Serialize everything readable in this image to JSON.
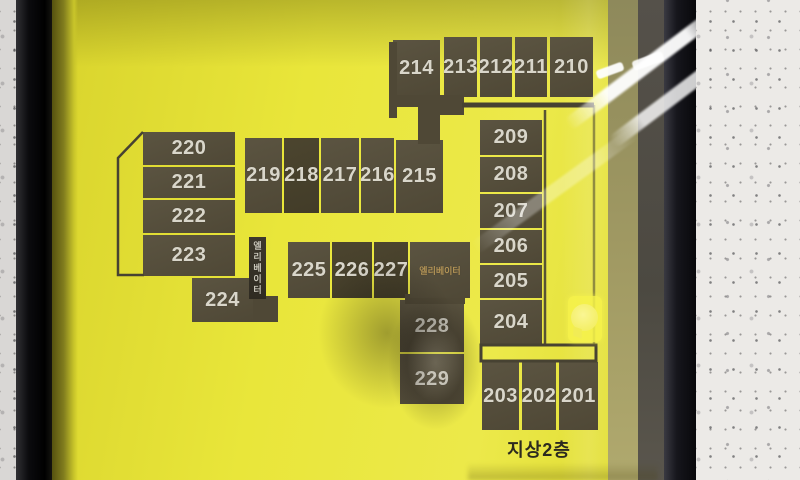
{
  "sign": {
    "type": "building-floor-directory",
    "colors": {
      "sign_yellow": "#e6e233",
      "block_brown": "#554e3b",
      "block_dark": "#2c2821",
      "outline": "#474232",
      "room_number_text": "#d9d6ca",
      "floor_label_text": "#2c2a1f",
      "elevator_text": "#c9c6ba",
      "elevator_room_text": "#b29356",
      "frame_black": "#141418",
      "wall_white": "#eceae7"
    }
  },
  "map": {
    "floor_label": "지상2층",
    "rooms": [
      {
        "number": "214",
        "x": 393,
        "y": 40,
        "w": 47,
        "h": 57
      },
      {
        "number": "213",
        "x": 444,
        "y": 37,
        "w": 33,
        "h": 60
      },
      {
        "number": "212",
        "x": 480,
        "y": 37,
        "w": 32,
        "h": 60
      },
      {
        "number": "211",
        "x": 515,
        "y": 37,
        "w": 32,
        "h": 60
      },
      {
        "number": "210",
        "x": 550,
        "y": 37,
        "w": 43,
        "h": 60
      },
      {
        "number": "220",
        "x": 143,
        "y": 132,
        "w": 92,
        "h": 33
      },
      {
        "number": "221",
        "x": 143,
        "y": 167,
        "w": 92,
        "h": 31
      },
      {
        "number": "222",
        "x": 143,
        "y": 200,
        "w": 92,
        "h": 33
      },
      {
        "number": "223",
        "x": 143,
        "y": 235,
        "w": 92,
        "h": 41
      },
      {
        "number": "224",
        "x": 192,
        "y": 278,
        "w": 61,
        "h": 44
      },
      {
        "number": "219",
        "x": 245,
        "y": 138,
        "w": 37,
        "h": 75
      },
      {
        "number": "218",
        "x": 284,
        "y": 138,
        "w": 35,
        "h": 75,
        "tone": "dim"
      },
      {
        "number": "217",
        "x": 321,
        "y": 138,
        "w": 38,
        "h": 75
      },
      {
        "number": "216",
        "x": 361,
        "y": 138,
        "w": 33,
        "h": 75
      },
      {
        "number": "215",
        "x": 396,
        "y": 140,
        "w": 47,
        "h": 73
      },
      {
        "number": "225",
        "x": 288,
        "y": 242,
        "w": 42,
        "h": 56
      },
      {
        "number": "226",
        "x": 332,
        "y": 242,
        "w": 40,
        "h": 56,
        "tone": "dim"
      },
      {
        "number": "227",
        "x": 374,
        "y": 242,
        "w": 34,
        "h": 56,
        "tone": "dim"
      },
      {
        "number": "228",
        "x": 400,
        "y": 300,
        "w": 64,
        "h": 52
      },
      {
        "number": "229",
        "x": 400,
        "y": 354,
        "w": 64,
        "h": 50
      },
      {
        "number": "209",
        "x": 480,
        "y": 120,
        "w": 62,
        "h": 35
      },
      {
        "number": "208",
        "x": 480,
        "y": 157,
        "w": 62,
        "h": 35
      },
      {
        "number": "207",
        "x": 480,
        "y": 194,
        "w": 62,
        "h": 34
      },
      {
        "number": "206",
        "x": 480,
        "y": 230,
        "w": 62,
        "h": 33
      },
      {
        "number": "205",
        "x": 480,
        "y": 265,
        "w": 62,
        "h": 33
      },
      {
        "number": "204",
        "x": 480,
        "y": 300,
        "w": 62,
        "h": 45
      },
      {
        "number": "203",
        "x": 482,
        "y": 362,
        "w": 37,
        "h": 68
      },
      {
        "number": "202",
        "x": 522,
        "y": 362,
        "w": 34,
        "h": 68
      },
      {
        "number": "201",
        "x": 559,
        "y": 362,
        "w": 39,
        "h": 68
      }
    ],
    "connectors": [
      {
        "x": 389,
        "y": 42,
        "w": 8,
        "h": 76
      },
      {
        "x": 389,
        "y": 95,
        "w": 30,
        "h": 12
      },
      {
        "x": 418,
        "y": 95,
        "w": 46,
        "h": 20
      },
      {
        "x": 418,
        "y": 112,
        "w": 22,
        "h": 32
      },
      {
        "x": 405,
        "y": 294,
        "w": 60,
        "h": 10
      },
      {
        "x": 253,
        "y": 296,
        "w": 25,
        "h": 26
      }
    ],
    "elevators": [
      {
        "label": "엘리베이터",
        "x": 249,
        "y": 237,
        "w": 17,
        "h": 62,
        "vertical": true
      },
      {
        "label": "엘리베이터",
        "x": 410,
        "y": 242,
        "w": 60,
        "h": 56,
        "vertical": false
      }
    ]
  }
}
